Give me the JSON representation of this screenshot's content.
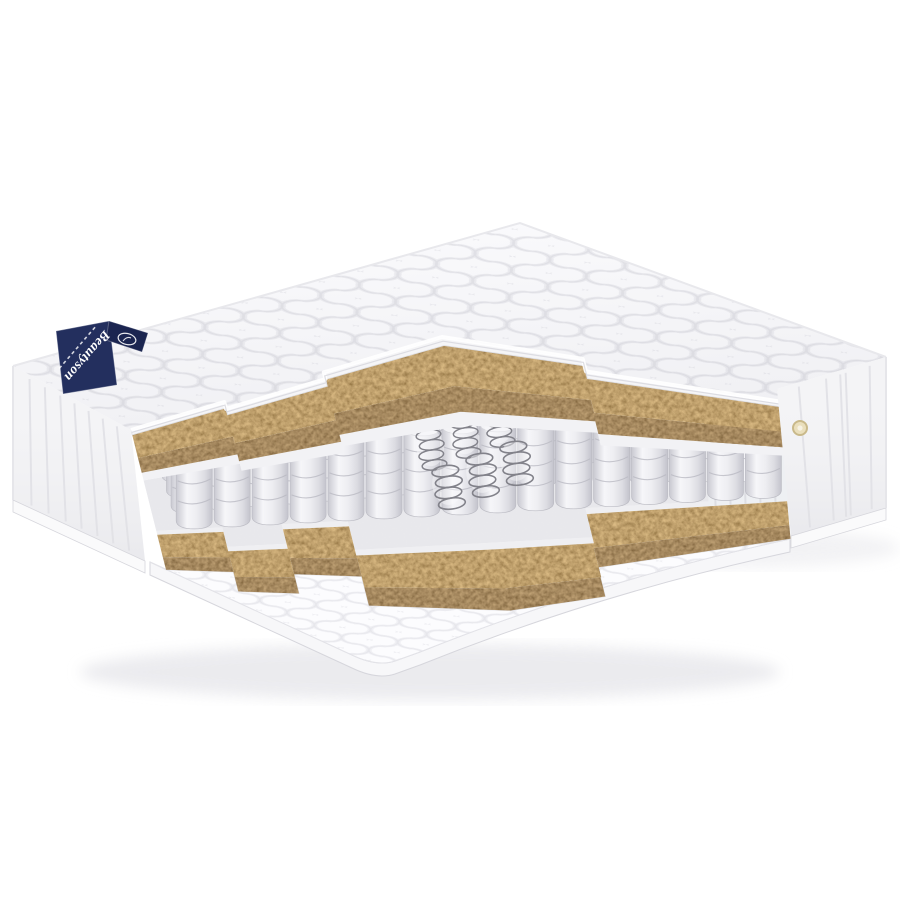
{
  "image": {
    "alt": "Spring mattress with stepped cutaway showing quilted cover, coconut coir layers and pocket springs"
  },
  "label": {
    "brand": "Beautyson"
  },
  "palette": {
    "background": "#ffffff",
    "fabric_white": "#fbfbfd",
    "quilt_line": "#e2e2e7",
    "quilt_line_soft": "#efeff3",
    "fabric_shadow": "#d6d6dc",
    "side_panel": "#f4f4f6",
    "seam_line": "#e1e1e6",
    "underside": "#f5f5f7",
    "felt": "#f2f2f5",
    "felt_low": "#efeff2",
    "springs_floor": "#e9e9ed",
    "wall_white": "#eef0f3",
    "pocket_edge": "#bcbcc4",
    "pocket_line": "#b7b7c0",
    "pocket_top": "#f3f3f6",
    "coir_base": "#7a5a2e",
    "coir_face_base": "#5a3f1e",
    "wire": "#82828a",
    "ledge_face": "#f7f7f9",
    "label_navy": "#232f5e",
    "label_navy_dark": "#1b2550",
    "label_text": "#ffffff",
    "eyelet_fill": "#eadfbc",
    "eyelet_ring": "#c9b98a",
    "shadow": "#e8e8ec"
  }
}
